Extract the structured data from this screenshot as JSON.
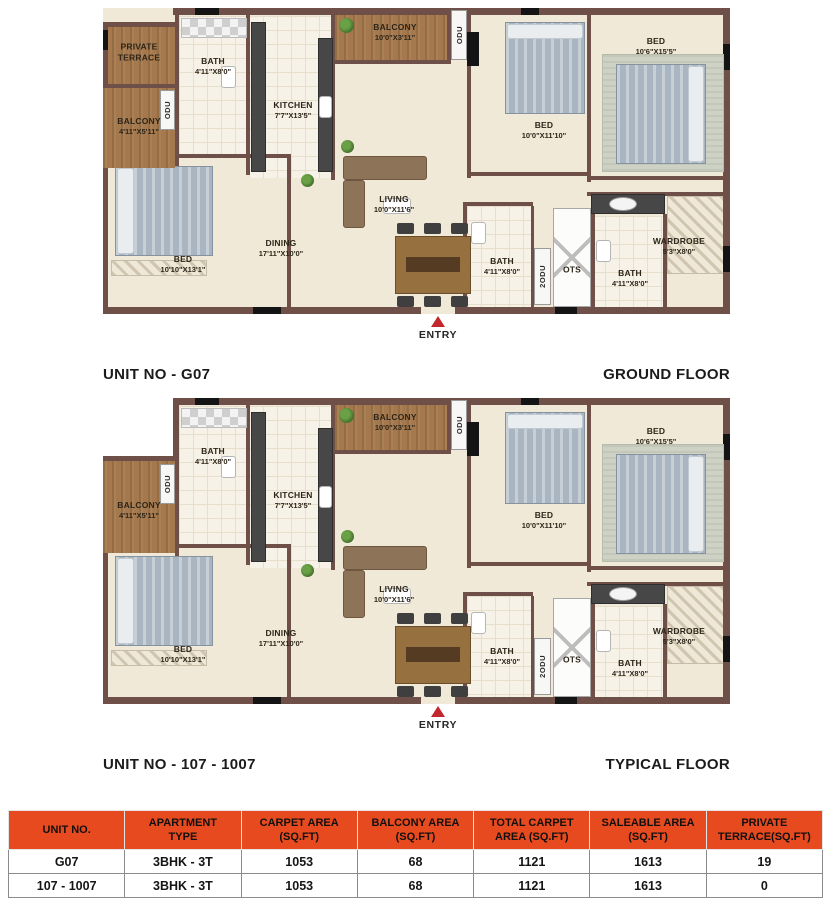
{
  "colors": {
    "table_header": "#e84a1f",
    "wall": "#6f5048",
    "floor": "#f0e9d8",
    "balcony_wood": "#a5794d",
    "entry_arrow": "#c1272d"
  },
  "plans": [
    {
      "id": "ground-floor",
      "title_left": "UNIT NO - G07",
      "title_right": "GROUND FLOOR",
      "entry": {
        "x": 335,
        "label": "ENTRY"
      },
      "rooms": [
        {
          "name": "private-terrace",
          "kind": "wood",
          "box": [
            0,
            14,
            72,
            62
          ],
          "label": "PRIVATE TERRACE",
          "label_at": [
            36,
            44
          ],
          "wrap": true
        },
        {
          "name": "wall-terrace-top",
          "kind": "wall",
          "box": [
            0,
            14,
            76,
            5
          ]
        },
        {
          "name": "wall-left",
          "kind": "wall",
          "box": [
            0,
            14,
            5,
            290
          ]
        },
        {
          "name": "wall-terrace-balcony",
          "kind": "wall",
          "box": [
            0,
            76,
            72,
            4
          ]
        },
        {
          "name": "wall-accent",
          "kind": "black",
          "box": [
            0,
            22,
            5,
            20
          ]
        },
        {
          "name": "balcony-left",
          "kind": "wood",
          "box": [
            0,
            80,
            72,
            80
          ],
          "label": "BALCONY",
          "dims": "4'11\"X5'11\"",
          "label_at": [
            36,
            118
          ]
        },
        {
          "name": "odu-left",
          "kind": "odubox",
          "box": [
            57,
            82,
            15,
            40
          ],
          "vlabel": "ODU"
        }
      ]
    },
    {
      "id": "typical-floor",
      "title_left": "UNIT NO - 107 - 1007",
      "title_right": "TYPICAL FLOOR",
      "entry": {
        "x": 335,
        "label": "ENTRY"
      },
      "rooms": [
        {
          "name": "outside-notch",
          "kind": "notch",
          "box": [
            0,
            0,
            70,
            58
          ]
        },
        {
          "name": "wall-body-left-upper",
          "kind": "wall",
          "box": [
            70,
            0,
            6,
            62
          ]
        },
        {
          "name": "wall-balcony-top",
          "kind": "wall",
          "box": [
            0,
            58,
            76,
            5
          ]
        },
        {
          "name": "wall-left",
          "kind": "wall",
          "box": [
            0,
            58,
            5,
            248
          ]
        },
        {
          "name": "balcony-left",
          "kind": "wood",
          "box": [
            0,
            63,
            72,
            92
          ],
          "label": "BALCONY",
          "dims": "4'11\"X5'11\"",
          "label_at": [
            36,
            112
          ]
        },
        {
          "name": "odu-left",
          "kind": "odubox",
          "box": [
            57,
            66,
            15,
            40
          ],
          "vlabel": "ODU"
        }
      ]
    }
  ],
  "shared_rooms": [
    {
      "name": "bath-1-floor",
      "kind": "tile",
      "box": [
        76,
        8,
        70,
        138
      ],
      "label": "BATH",
      "dims": "4'11\"X8'0\"",
      "label_at": [
        110,
        58
      ]
    },
    {
      "name": "kitchen-floor",
      "kind": "tile",
      "box": [
        146,
        8,
        84,
        162
      ],
      "label": "KITCHEN",
      "dims": "7'7\"X13'5\"",
      "label_at": [
        190,
        102
      ]
    },
    {
      "name": "balcony-top-floor",
      "kind": "wood",
      "box": [
        232,
        0,
        114,
        52
      ],
      "label": "BALCONY",
      "dims": "10'0\"X3'11\"",
      "label_at": [
        292,
        24
      ]
    },
    {
      "name": "bath-2-floor",
      "kind": "tile",
      "box": [
        364,
        198,
        66,
        101
      ]
    },
    {
      "name": "bath-3-floor",
      "kind": "tile",
      "box": [
        488,
        208,
        74,
        91
      ]
    },
    {
      "name": "wardrobe-floor",
      "kind": "hatch",
      "box": [
        564,
        188,
        58,
        78
      ]
    },
    {
      "name": "bedroom-1-rug-strip",
      "kind": "hatch",
      "box": [
        8,
        252,
        96,
        16
      ]
    },
    {
      "name": "wall-top",
      "kind": "wall",
      "box": [
        70,
        0,
        557,
        7
      ]
    },
    {
      "name": "wall-right",
      "kind": "wall",
      "box": [
        620,
        0,
        7,
        306
      ]
    },
    {
      "name": "wall-bottom",
      "kind": "wall",
      "box": [
        0,
        299,
        627,
        7
      ]
    },
    {
      "name": "wall-leftblock-edge",
      "kind": "wall",
      "box": [
        72,
        7,
        4,
        163
      ]
    },
    {
      "name": "wall-bath1-kitchen",
      "kind": "wall",
      "box": [
        143,
        7,
        4,
        160
      ]
    },
    {
      "name": "wall-kitchen-right",
      "kind": "wall",
      "box": [
        228,
        0,
        4,
        172
      ]
    },
    {
      "name": "wall-balcony-living",
      "kind": "wall",
      "box": [
        228,
        52,
        120,
        4
      ]
    },
    {
      "name": "wall-balcony-odu",
      "kind": "wall",
      "box": [
        344,
        0,
        4,
        56
      ]
    },
    {
      "name": "wall-bed2-left",
      "kind": "wall",
      "box": [
        364,
        0,
        4,
        170
      ]
    },
    {
      "name": "wall-bed2-bed3",
      "kind": "wall",
      "box": [
        484,
        0,
        4,
        174
      ]
    },
    {
      "name": "wall-bed2-bottom",
      "kind": "wall",
      "box": [
        364,
        164,
        124,
        4
      ]
    },
    {
      "name": "wall-bed3-bottom",
      "kind": "wall",
      "box": [
        484,
        168,
        143,
        4
      ]
    },
    {
      "name": "wall-bed1-top",
      "kind": "wall",
      "box": [
        0,
        146,
        188,
        4
      ]
    },
    {
      "name": "wall-bed1-right",
      "kind": "wall",
      "box": [
        184,
        146,
        4,
        153
      ]
    },
    {
      "name": "wall-bath2-top",
      "kind": "wall",
      "box": [
        360,
        194,
        70,
        4
      ]
    },
    {
      "name": "wall-bath2-left",
      "kind": "wall",
      "box": [
        360,
        194,
        4,
        105
      ]
    },
    {
      "name": "wall-bath2-right",
      "kind": "wall",
      "box": [
        428,
        198,
        3,
        101
      ]
    },
    {
      "name": "wall-vanity-top",
      "kind": "wall",
      "box": [
        484,
        184,
        143,
        4
      ]
    },
    {
      "name": "wall-ots-right",
      "kind": "wall",
      "box": [
        488,
        204,
        4,
        95
      ]
    },
    {
      "name": "wall-bath3-wardrobe",
      "kind": "wall",
      "box": [
        560,
        206,
        4,
        93
      ]
    },
    {
      "name": "wall-accent",
      "kind": "black",
      "box": [
        92,
        0,
        24,
        7
      ]
    },
    {
      "name": "wall-accent",
      "kind": "black",
      "box": [
        418,
        0,
        18,
        7
      ]
    },
    {
      "name": "wall-accent",
      "kind": "black",
      "box": [
        620,
        36,
        7,
        26
      ]
    },
    {
      "name": "wall-accent",
      "kind": "black",
      "box": [
        620,
        238,
        7,
        26
      ]
    },
    {
      "name": "wall-accent",
      "kind": "black",
      "box": [
        150,
        299,
        28,
        7
      ]
    },
    {
      "name": "wall-accent",
      "kind": "black",
      "box": [
        452,
        299,
        22,
        7
      ]
    },
    {
      "name": "entry-door-opening",
      "kind": "dooropen",
      "box": [
        318,
        299,
        34,
        7
      ]
    },
    {
      "name": "kitchen-counter-left",
      "kind": "counter",
      "box": [
        148,
        14,
        15,
        150
      ]
    },
    {
      "name": "kitchen-counter-right",
      "kind": "counter",
      "box": [
        215,
        30,
        15,
        134
      ]
    },
    {
      "name": "stove",
      "kind": "fixture",
      "box": [
        216,
        88,
        13,
        22
      ]
    },
    {
      "name": "washer-tiles",
      "kind": "checker",
      "box": [
        78,
        10,
        66,
        20
      ]
    },
    {
      "name": "plant-balcony",
      "kind": "plant",
      "box": [
        236,
        10,
        15,
        15
      ]
    },
    {
      "name": "plant-living",
      "kind": "plant",
      "box": [
        238,
        132,
        13,
        13
      ]
    },
    {
      "name": "plant-kitchen",
      "kind": "plant",
      "box": [
        198,
        166,
        13,
        13
      ]
    },
    {
      "name": "bed-2-graphic",
      "kind": "bed",
      "box": [
        402,
        14,
        80,
        92
      ]
    },
    {
      "name": "bed-2-pillow",
      "kind": "pillow",
      "box": [
        404,
        16,
        76,
        15
      ]
    },
    {
      "name": "bed-3-rug",
      "kind": "rug",
      "box": [
        499,
        46,
        122,
        118
      ]
    },
    {
      "name": "bed-3-graphic",
      "kind": "bed",
      "box": [
        513,
        56,
        90,
        100
      ]
    },
    {
      "name": "bed-3-pillow",
      "kind": "pillow",
      "box": [
        585,
        58,
        16,
        96
      ]
    },
    {
      "name": "bed-1-graphic",
      "kind": "bed",
      "box": [
        12,
        158,
        98,
        90
      ]
    },
    {
      "name": "bed-1-pillow",
      "kind": "pillow",
      "box": [
        14,
        160,
        17,
        86
      ]
    },
    {
      "name": "sofa-horizontal",
      "kind": "sofa",
      "box": [
        240,
        148,
        84,
        24
      ]
    },
    {
      "name": "sofa-vertical",
      "kind": "sofa",
      "box": [
        240,
        172,
        22,
        48
      ]
    },
    {
      "name": "coffee-table",
      "kind": "fixture",
      "box": [
        280,
        190,
        28,
        16
      ]
    },
    {
      "name": "dining-table",
      "kind": "table",
      "box": [
        292,
        228,
        76,
        58
      ]
    },
    {
      "name": "dining-table-runner",
      "kind": "tabledark",
      "box": [
        303,
        249,
        54,
        15
      ]
    },
    {
      "name": "dining-chair",
      "kind": "chair",
      "box": [
        294,
        215,
        17,
        11
      ]
    },
    {
      "name": "dining-chair",
      "kind": "chair",
      "box": [
        321,
        215,
        17,
        11
      ]
    },
    {
      "name": "dining-chair",
      "kind": "chair",
      "box": [
        348,
        215,
        17,
        11
      ]
    },
    {
      "name": "dining-chair",
      "kind": "chair",
      "box": [
        294,
        288,
        17,
        11
      ]
    },
    {
      "name": "dining-chair",
      "kind": "chair",
      "box": [
        321,
        288,
        17,
        11
      ]
    },
    {
      "name": "dining-chair",
      "kind": "chair",
      "box": [
        348,
        288,
        17,
        11
      ]
    },
    {
      "name": "toilet-bath1",
      "kind": "fixture",
      "box": [
        118,
        58,
        15,
        22
      ]
    },
    {
      "name": "toilet-bath2",
      "kind": "fixture",
      "box": [
        368,
        214,
        15,
        22
      ]
    },
    {
      "name": "toilet-bath3",
      "kind": "fixture",
      "box": [
        493,
        232,
        15,
        22
      ]
    },
    {
      "name": "vanity-counter",
      "kind": "counter",
      "box": [
        488,
        186,
        74,
        20
      ]
    },
    {
      "name": "basin",
      "kind": "oval",
      "box": [
        506,
        189,
        28,
        14
      ]
    },
    {
      "name": "ots-shaft",
      "kind": "ots",
      "box": [
        450,
        200,
        38,
        99
      ],
      "label": "OTS",
      "label_at": [
        469,
        262
      ]
    },
    {
      "name": "odu-top",
      "kind": "odubox",
      "box": [
        348,
        2,
        16,
        50
      ],
      "vlabel": "ODU"
    },
    {
      "name": "odu-top-unit",
      "kind": "black",
      "box": [
        364,
        24,
        12,
        34
      ]
    },
    {
      "name": "odu-2",
      "kind": "odubox",
      "box": [
        431,
        240,
        17,
        57
      ],
      "vlabel": "2ODU"
    },
    {
      "name": "bed-2-label",
      "kind": "label",
      "label": "BED",
      "dims": "10'0\"X11'10\"",
      "label_at": [
        441,
        122
      ]
    },
    {
      "name": "bed-3-label",
      "kind": "label",
      "label": "BED",
      "dims": "10'6\"X15'5\"",
      "label_at": [
        553,
        38
      ]
    },
    {
      "name": "bed-1-label",
      "kind": "label",
      "label": "BED",
      "dims": "10'10\"X13'1\"",
      "label_at": [
        80,
        256
      ]
    },
    {
      "name": "dining-label",
      "kind": "label",
      "label": "DINING",
      "dims": "17'11\"X10'0\"",
      "label_at": [
        178,
        240
      ]
    },
    {
      "name": "living-label",
      "kind": "label",
      "label": "LIVING",
      "dims": "10'0\"X11'6\"",
      "label_at": [
        291,
        196
      ]
    },
    {
      "name": "bath-2-label",
      "kind": "label",
      "label": "BATH",
      "dims": "4'11\"X8'0\"",
      "label_at": [
        399,
        258
      ]
    },
    {
      "name": "bath-3-label",
      "kind": "label",
      "label": "BATH",
      "dims": "4'11\"X8'0\"",
      "label_at": [
        527,
        270
      ]
    },
    {
      "name": "wardrobe-label",
      "kind": "label",
      "label": "WARDROBE",
      "dims": "5'3\"X8'0\"",
      "label_at": [
        576,
        238
      ]
    }
  ],
  "table": {
    "columns": [
      {
        "line1": "UNIT NO.",
        "line2": ""
      },
      {
        "line1": "APARTMENT",
        "line2": "TYPE"
      },
      {
        "line1": "CARPET AREA",
        "line2": "(SQ.FT)"
      },
      {
        "line1": "BALCONY AREA",
        "line2": "(SQ.FT)"
      },
      {
        "line1": "TOTAL CARPET",
        "line2": "AREA (SQ.FT)"
      },
      {
        "line1": "SALEABLE AREA",
        "line2": "(SQ.FT)"
      },
      {
        "line1": "PRIVATE",
        "line2": "TERRACE(SQ.FT)"
      }
    ],
    "rows": [
      [
        "G07",
        "3BHK - 3T",
        "1053",
        "68",
        "1121",
        "1613",
        "19"
      ],
      [
        "107 - 1007",
        "3BHK - 3T",
        "1053",
        "68",
        "1121",
        "1613",
        "0"
      ]
    ]
  }
}
